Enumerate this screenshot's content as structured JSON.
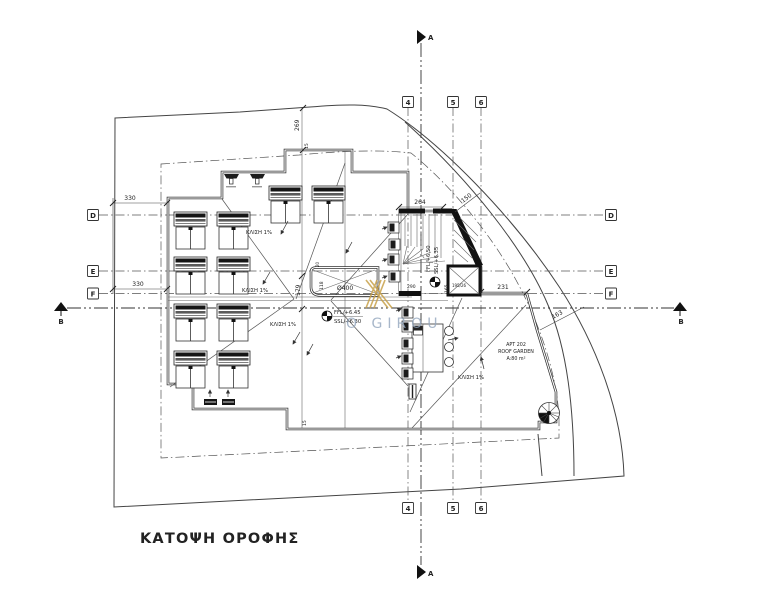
{
  "drawing": {
    "title": "ΚΑΤΟΨΗ ΟΡΟΦΗΣ",
    "watermark_text": "O GIROU",
    "grid_columns": {
      "c4": "4",
      "c5": "5",
      "c6": "6"
    },
    "grid_rows": {
      "rD": "D",
      "rE": "E",
      "rF": "F"
    },
    "sections": {
      "a": "A",
      "b": "B"
    },
    "dims": {
      "left_top": "330",
      "left_bottom": "330",
      "top_vert": "269",
      "top_step": "15",
      "stair_width": "264",
      "stair_diag": "150",
      "terrace_top": "231",
      "terrace_diag": "163",
      "axis_vert": "179",
      "stair_bottom": "290",
      "stair_inner": "165",
      "shaft_size": "195/26",
      "planter_wall": "20",
      "planter_width": "118",
      "planter_length": "Ø400",
      "bottom_step": "15"
    },
    "levels": {
      "stair_ffl": "FFL/+6.50",
      "stair_ssl": "SSL/+6.35",
      "roof_ffl": "FFL/+6.45",
      "roof_ssl": "SSL/+6.30"
    },
    "slope_labels": {
      "s1": "ΚΛΙΣΗ 1%",
      "s2": "ΚΛΙΣΗ 1%",
      "s3": "ΚΛΙΣΗ 1%",
      "s4": "ΚΛΙΣΗ 1%"
    },
    "apartment": {
      "line1": "APT 202",
      "line2": "ROOF GARDEN",
      "line3": "A:80 m²"
    }
  }
}
